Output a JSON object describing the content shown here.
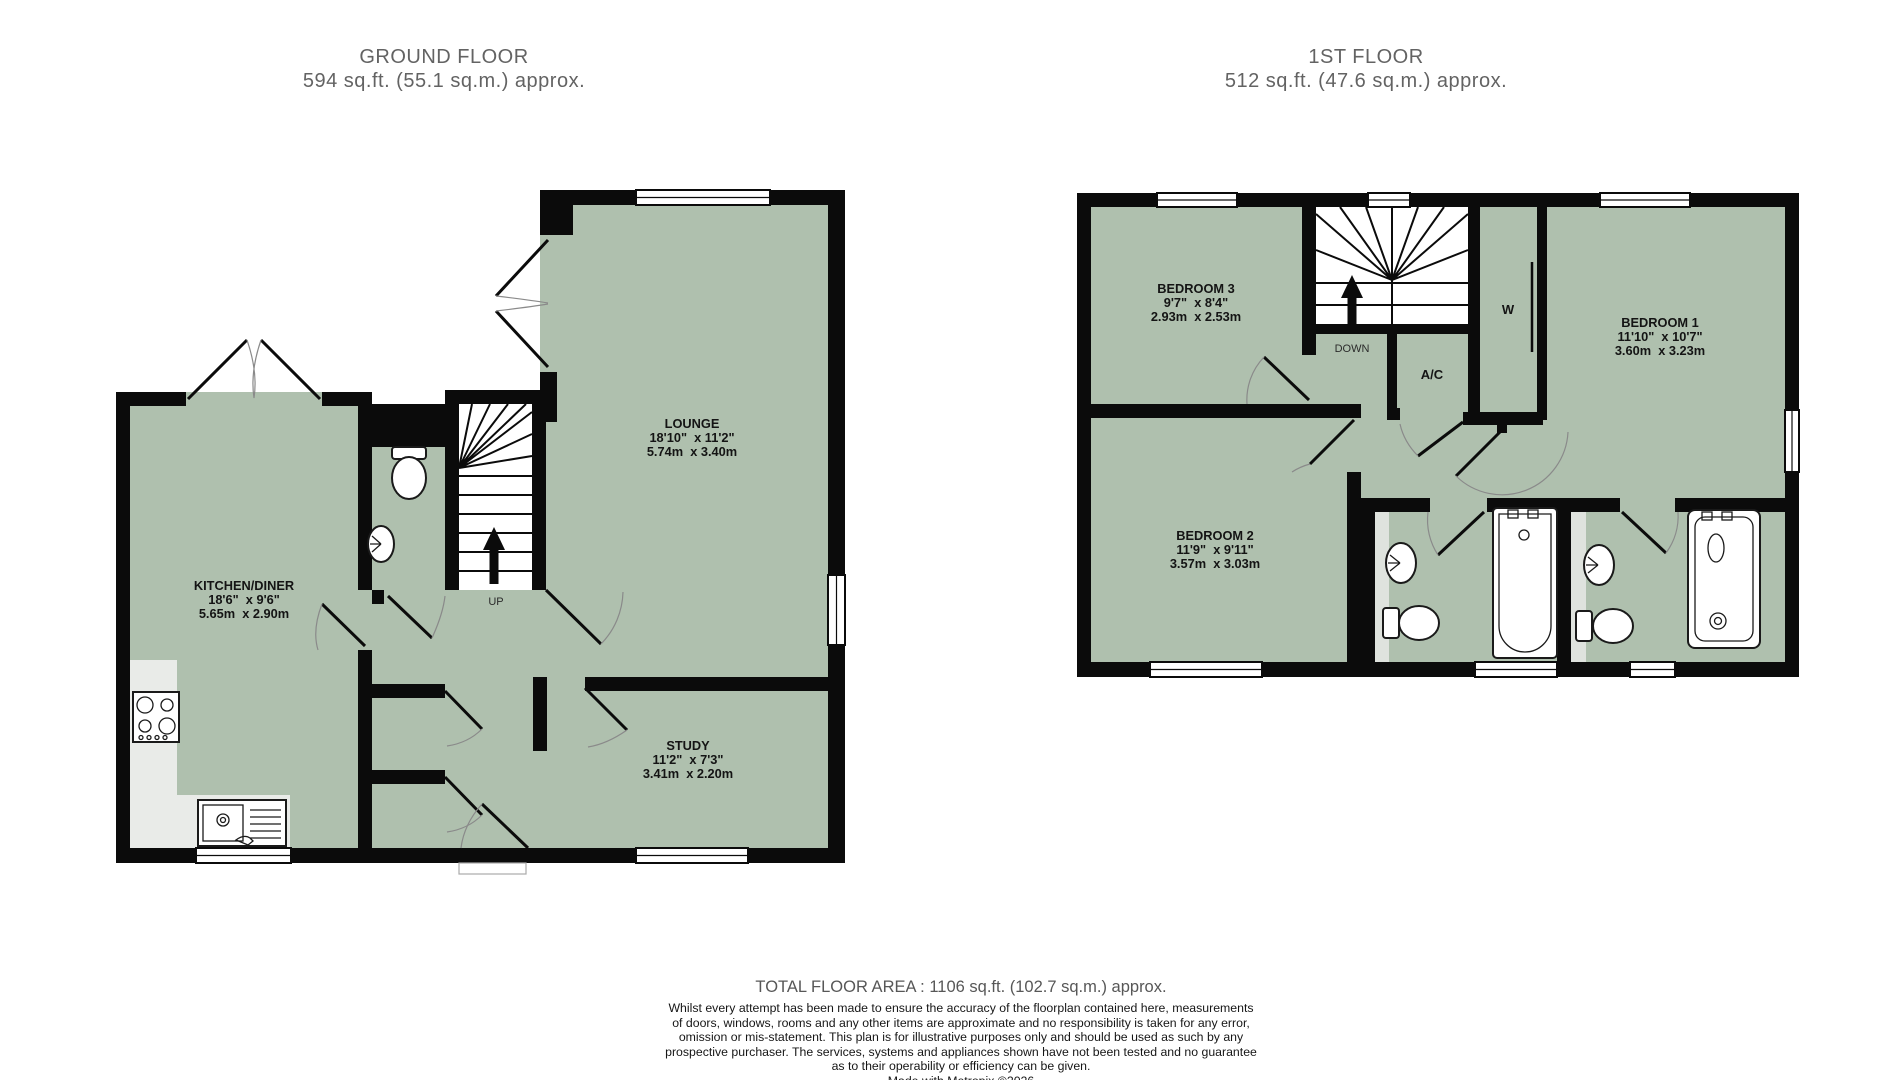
{
  "ground_floor": {
    "title": "GROUND FLOOR",
    "area": "594 sq.ft. (55.1 sq.m.) approx.",
    "rooms": {
      "lounge": {
        "name": "LOUNGE",
        "imperial": "18'10\"  x 11'2\"",
        "metric": "5.74m  x 3.40m"
      },
      "kitchen": {
        "name": "KITCHEN/DINER",
        "imperial": "18'6\"  x 9'6\"",
        "metric": "5.65m  x 2.90m"
      },
      "study": {
        "name": "STUDY",
        "imperial": "11'2\"  x 7'3\"",
        "metric": "3.41m  x 2.20m"
      }
    },
    "annotations": {
      "up": "UP"
    }
  },
  "first_floor": {
    "title": "1ST FLOOR",
    "area": "512 sq.ft. (47.6 sq.m.) approx.",
    "rooms": {
      "bedroom1": {
        "name": "BEDROOM 1",
        "imperial": "11'10\"  x 10'7\"",
        "metric": "3.60m  x 3.23m"
      },
      "bedroom2": {
        "name": "BEDROOM 2",
        "imperial": "11'9\"  x 9'11\"",
        "metric": "3.57m  x 3.03m"
      },
      "bedroom3": {
        "name": "BEDROOM 3",
        "imperial": "9'7\"  x 8'4\"",
        "metric": "2.93m  x 2.53m"
      }
    },
    "annotations": {
      "down": "DOWN",
      "airing_cupboard": "A/C",
      "wardrobe": "W"
    }
  },
  "footer": {
    "total_area": "TOTAL FLOOR AREA : 1106 sq.ft. (102.7 sq.m.) approx.",
    "disclaimer_lines": [
      "Whilst every attempt has been made to ensure the accuracy of the floorplan contained here, measurements",
      "of doors, windows, rooms and any other items are approximate and no responsibility is taken for any error,",
      "omission or mis-statement. This plan is for illustrative purposes only and should be used as such by any",
      "prospective purchaser. The services, systems and appliances shown have not been tested and no guarantee",
      "as to their operability or efficiency can be given."
    ],
    "credit": "Made with Metropix ©2026"
  },
  "colors": {
    "room_fill": "#afc0ae",
    "wall": "#0b0b0b",
    "counter": "#e9ebe8",
    "bath_strip": "#dfe3de",
    "heading_text": "#636363"
  }
}
